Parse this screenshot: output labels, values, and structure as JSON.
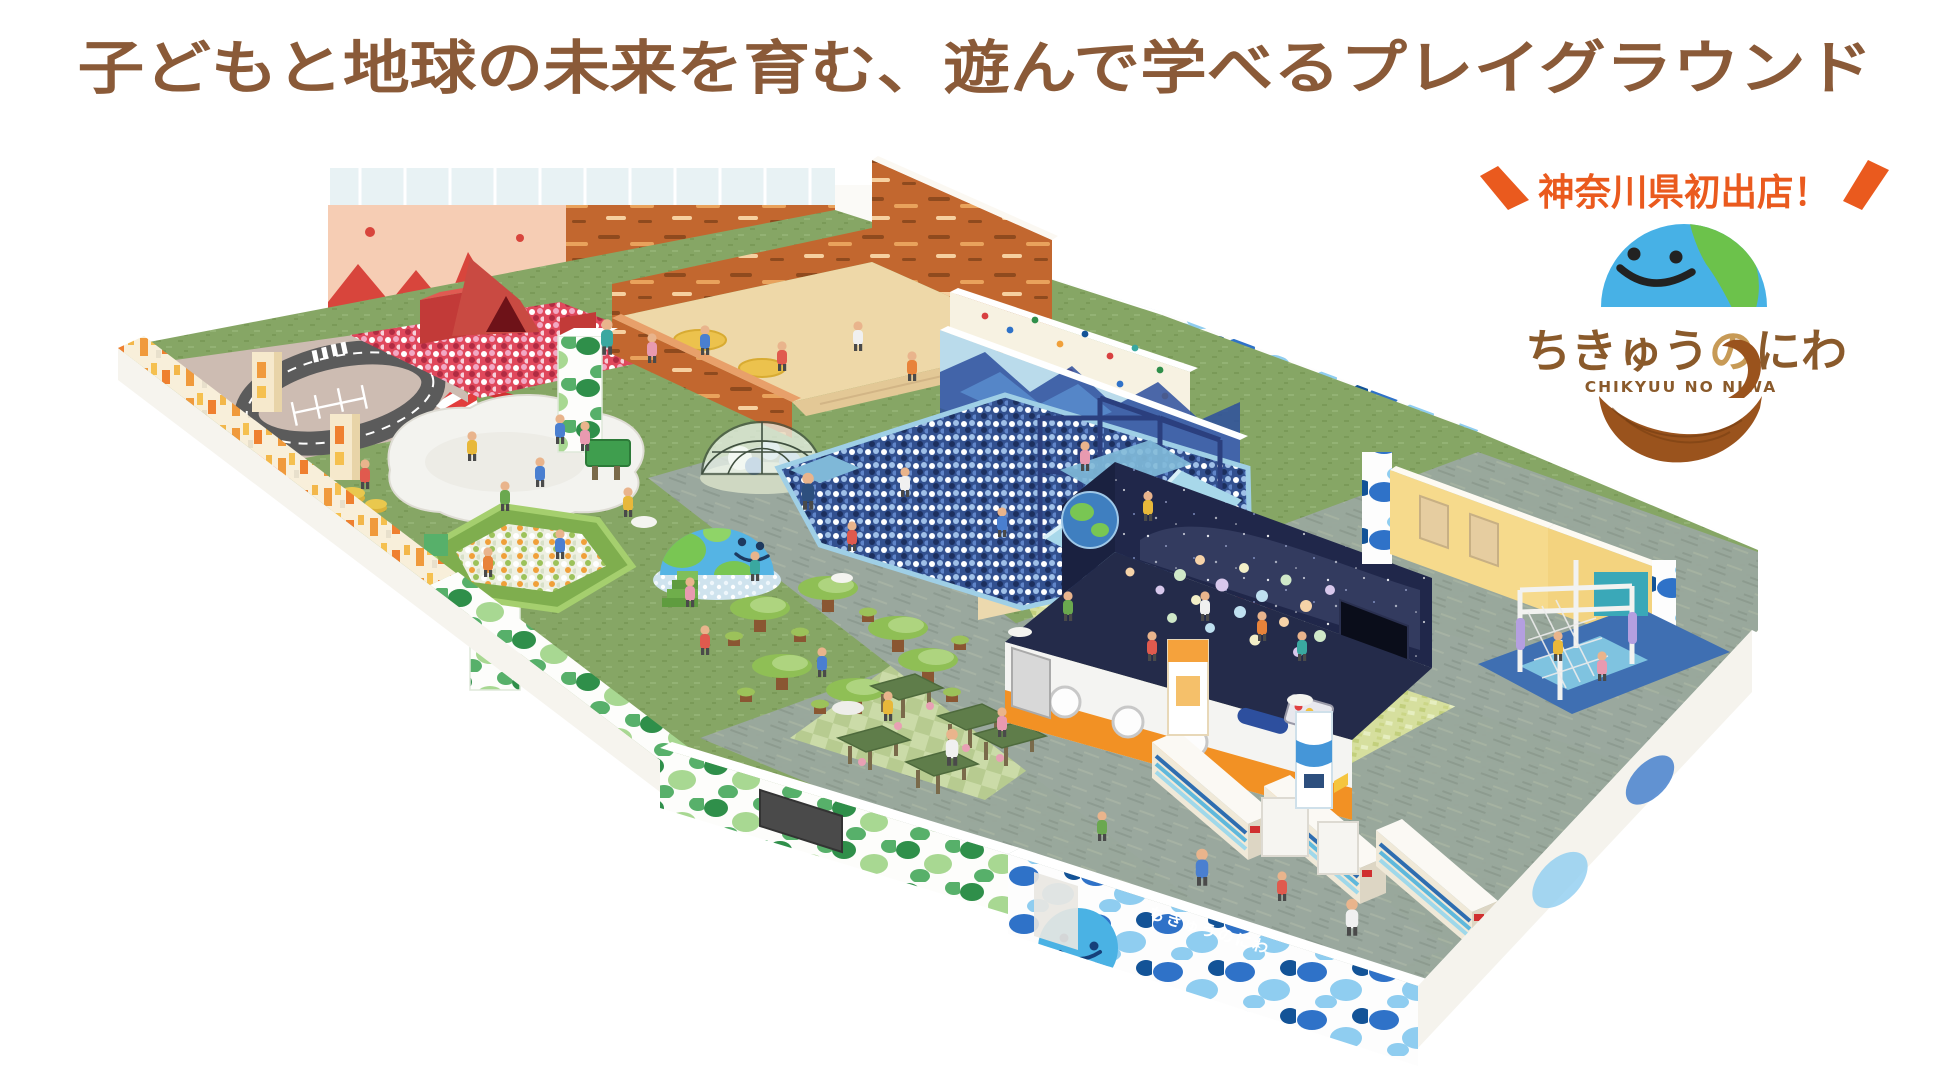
{
  "headline": {
    "text": "子どもと地球の未来を育む、遊んで学べるプレイグラウンド",
    "color": "#8a5a38"
  },
  "badge": {
    "text": "神奈川県初出店！",
    "color": "#ea5a1e"
  },
  "logo": {
    "jp_1": "ちきゅう",
    "jp_2": "の",
    "jp_3": "にわ",
    "en": "CHIKYUU NO NIWA",
    "colors": {
      "earth": "#47b1e6",
      "land": "#6cc24b",
      "face": "#222222",
      "text": "#8a5a2b",
      "text_accent": "#c79a56",
      "hand": "#9a531d"
    }
  },
  "entrance": {
    "wall_text": "ちきゅうのにわ"
  },
  "palette": {
    "grass": "#86a665",
    "path": "#9aa89e",
    "sand": "#eed8a8",
    "terracotta": "#c2672f",
    "volcano_peach": "#f6cdb4",
    "volcano_red": "#d8453c",
    "ball_red": "#e0485c",
    "ball_blue": "#32508f",
    "mural_blue": "#badbeb",
    "navy_frame": "#2b3f7e",
    "slide_blue": "#a8d8ea",
    "cream_wall": "#f6e9cc",
    "star_navy": "#20274a",
    "facade_orange": "#f29124",
    "room_yellow": "#f6da8c",
    "leaf_green": "#2f8f4a",
    "camo_blue": "#2f72c8",
    "locker_cream": "#f0e9d8",
    "locker_blue": "#2e6db0",
    "track_gray": "#5b5b5b",
    "curb_red": "#e23d3d"
  }
}
